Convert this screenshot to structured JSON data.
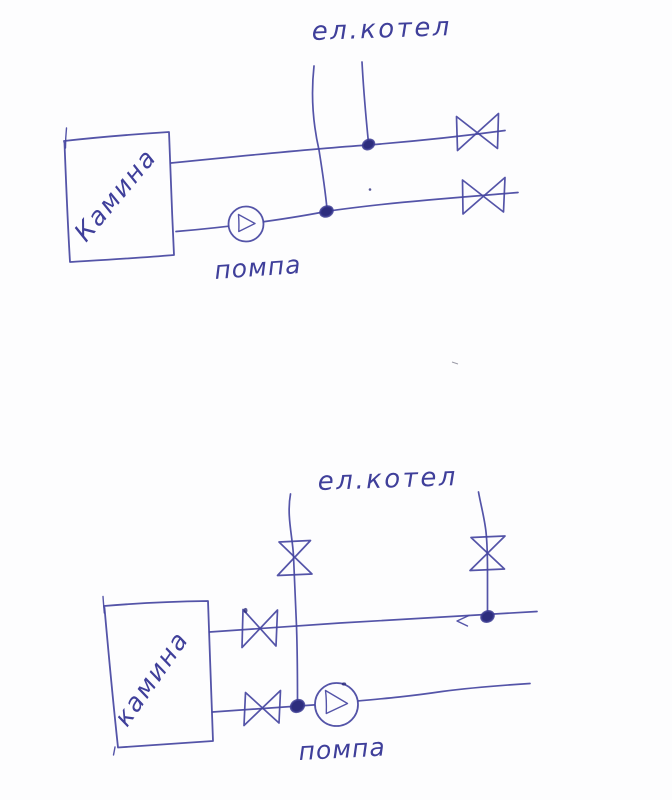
{
  "page": {
    "background_color": "#fdfdfe",
    "ink_color": "#4545a1",
    "ink_dark_color": "#2d2d7d",
    "description_style": "hand-drawn pen sketch, two heating schematics"
  },
  "diagrams": {
    "top": {
      "boiler_label": "ел.котел",
      "heat_source_label": "Камина",
      "pump_label": "помпа"
    },
    "bottom": {
      "boiler_label": "ел.котел",
      "heat_source_label": "камина",
      "pump_label": "помпа"
    }
  }
}
